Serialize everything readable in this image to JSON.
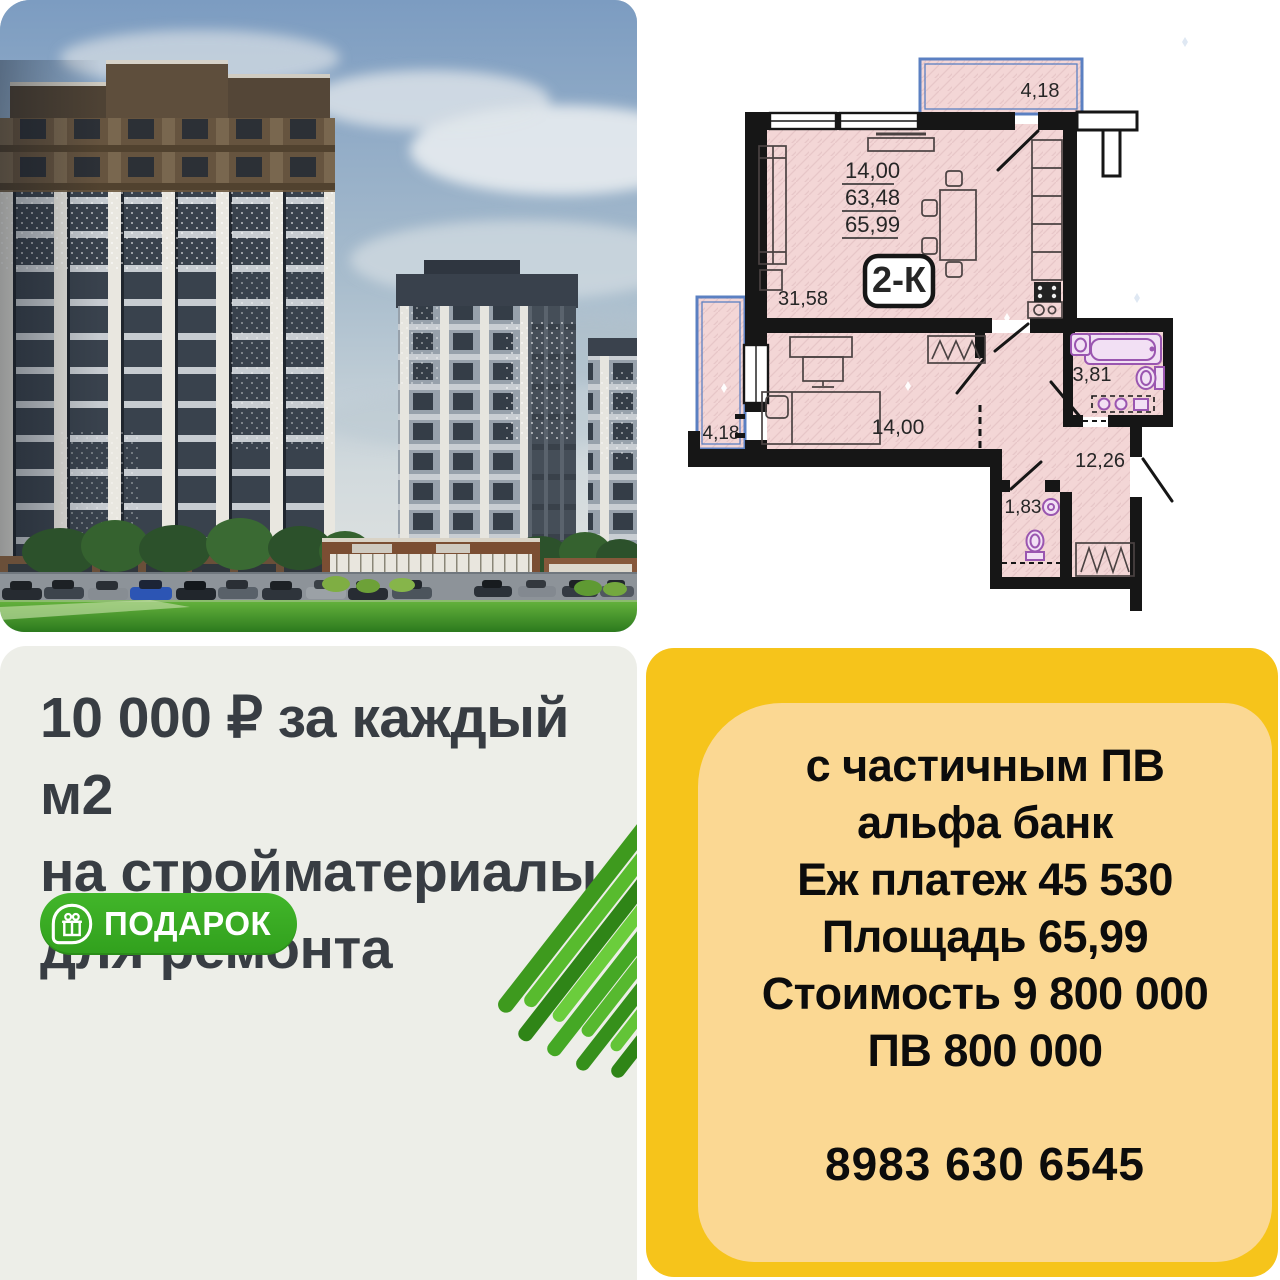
{
  "floor_plan": {
    "unit_type": "2-К",
    "area_stack_1": "14,00",
    "area_stack_2": "63,48",
    "area_stack_3": "65,99",
    "area_living_kitchen": "31,58",
    "area_bedroom": "14,00",
    "area_bathroom": "3,81",
    "area_hall": "12,26",
    "area_wc": "1,83",
    "area_balcony_top": "4,18",
    "area_balcony_left": "4,18"
  },
  "promo_card": {
    "line1": "10 000 ₽ за каждый м2",
    "line2": "на стройматериалы",
    "line3": "для ремонта",
    "badge_label": "ПОДАРОК"
  },
  "offer_card": {
    "lines": [
      "с частичным ПВ",
      "альфа банк",
      "Еж платеж 45 530",
      "Площадь 65,99",
      "Стоимость 9 800 000",
      "ПВ 800 000"
    ],
    "phone": "8983 630 6545"
  },
  "colors": {
    "offer_bg": "#f6c41b",
    "offer_inner": "#fbd893",
    "promo_bg": "#edeee8",
    "badge_green": "#3ab024",
    "plan_pink": "#f3d6d6",
    "balcony_blue": "#5b80c2",
    "fixture_purple": "#9a56b0",
    "headline_text": "#383d43"
  }
}
